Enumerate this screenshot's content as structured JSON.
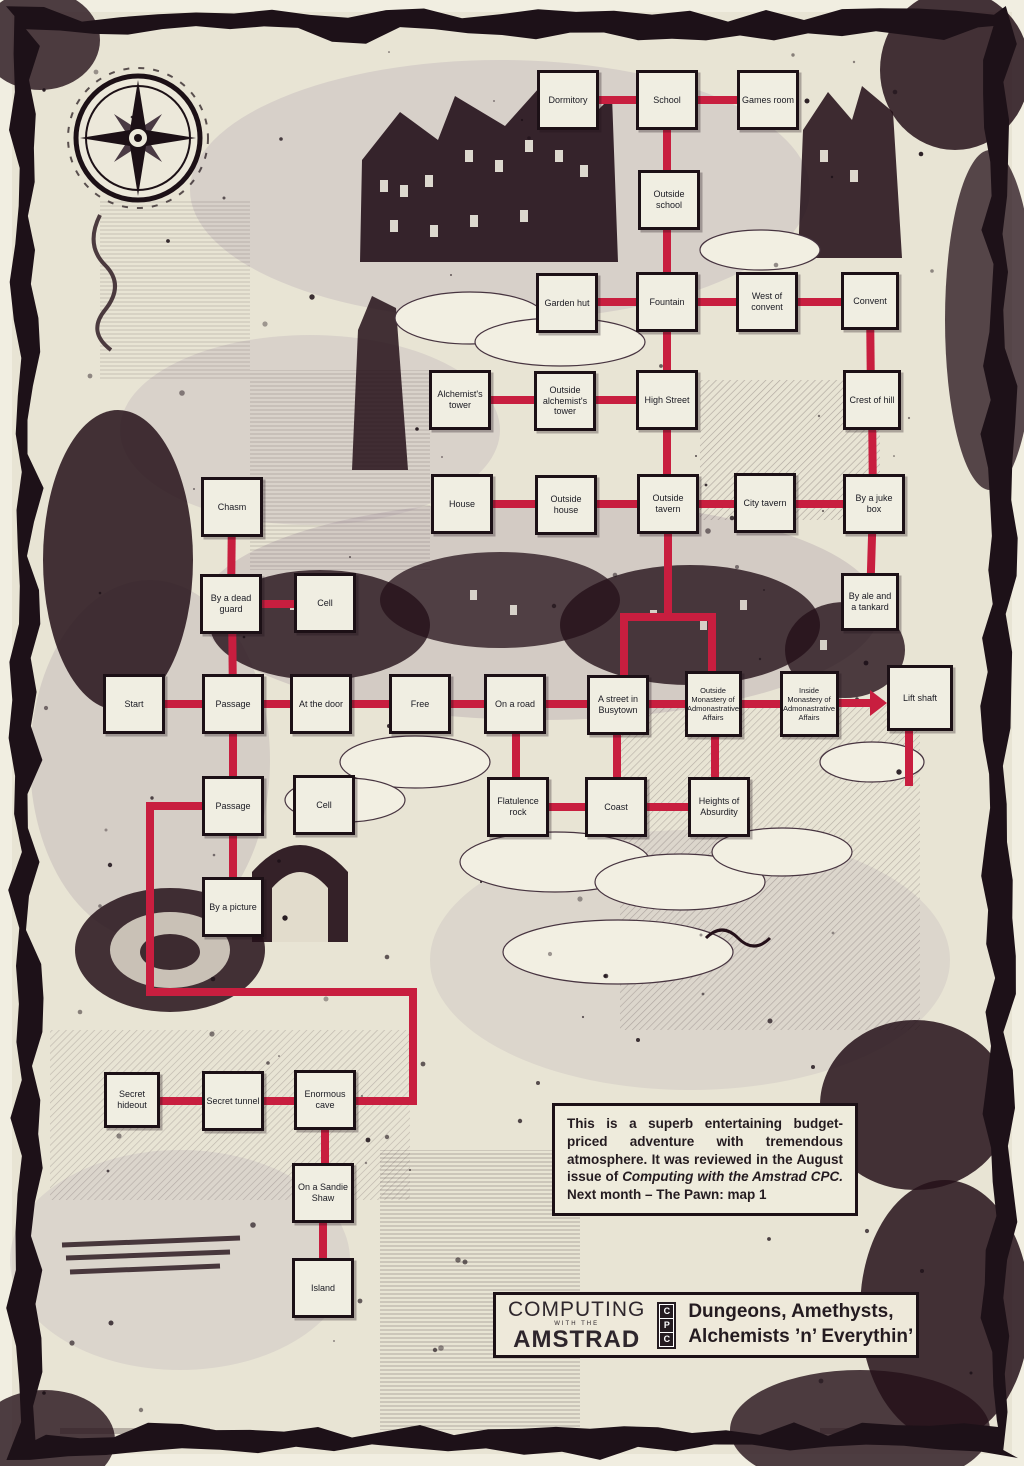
{
  "page_title": "Adventure game map — Dungeons, Amethysts, Alchemists ’n’ Everythin’",
  "colors": {
    "paper": "#e8e4d4",
    "ink": "#1d1118",
    "route_red": "#c81e3f",
    "box_fill": "#f0eee2"
  },
  "map_data": {
    "type": "diagram",
    "nodes": [
      {
        "id": "dormitory",
        "label": "Dormitory",
        "x": 568,
        "y": 100
      },
      {
        "id": "school",
        "label": "School",
        "x": 667,
        "y": 100
      },
      {
        "id": "games-room",
        "label": "Games room",
        "x": 768,
        "y": 100
      },
      {
        "id": "outside-school",
        "label": "Outside school",
        "x": 669,
        "y": 200
      },
      {
        "id": "garden-hut",
        "label": "Garden hut",
        "x": 567,
        "y": 303
      },
      {
        "id": "fountain",
        "label": "Fountain",
        "x": 667,
        "y": 302
      },
      {
        "id": "west-of-convent",
        "label": "West of convent",
        "x": 767,
        "y": 302
      },
      {
        "id": "convent",
        "label": "Convent",
        "x": 870,
        "y": 301,
        "w": 58,
        "h": 58
      },
      {
        "id": "alchemists-tower",
        "label": "Alchemist's tower",
        "x": 460,
        "y": 400
      },
      {
        "id": "outside-alchemists-tower",
        "label": "Outside alchemist's tower",
        "x": 565,
        "y": 401
      },
      {
        "id": "high-street",
        "label": "High Street",
        "x": 667,
        "y": 400
      },
      {
        "id": "crest-of-hill",
        "label": "Crest of hill",
        "x": 872,
        "y": 400,
        "w": 58
      },
      {
        "id": "chasm",
        "label": "Chasm",
        "x": 232,
        "y": 507
      },
      {
        "id": "house",
        "label": "House",
        "x": 462,
        "y": 504
      },
      {
        "id": "outside-house",
        "label": "Outside house",
        "x": 566,
        "y": 505
      },
      {
        "id": "outside-tavern",
        "label": "Outside tavern",
        "x": 668,
        "y": 504
      },
      {
        "id": "city-tavern",
        "label": "City tavern",
        "x": 765,
        "y": 503
      },
      {
        "id": "by-a-juke-box",
        "label": "By a juke box",
        "x": 874,
        "y": 504
      },
      {
        "id": "by-a-dead-guard",
        "label": "By a dead guard",
        "x": 231,
        "y": 604
      },
      {
        "id": "cell-upper",
        "label": "Cell",
        "x": 325,
        "y": 603
      },
      {
        "id": "by-ale-and-a-tankard",
        "label": "By ale and a tankard",
        "x": 870,
        "y": 602,
        "w": 58,
        "h": 58
      },
      {
        "id": "start",
        "label": "Start",
        "x": 134,
        "y": 704
      },
      {
        "id": "passage-upper",
        "label": "Passage",
        "x": 233,
        "y": 704
      },
      {
        "id": "at-the-door",
        "label": "At the door",
        "x": 321,
        "y": 704
      },
      {
        "id": "free",
        "label": "Free",
        "x": 420,
        "y": 704
      },
      {
        "id": "on-a-road",
        "label": "On a road",
        "x": 515,
        "y": 704
      },
      {
        "id": "a-street-in-busytown",
        "label": "A street in Busytown",
        "x": 618,
        "y": 705
      },
      {
        "id": "outside-monastery",
        "label": "Outside Monastery of Admonastrative Affairs",
        "x": 713,
        "y": 704,
        "w": 57,
        "h": 66,
        "fs": 7.5
      },
      {
        "id": "inside-monastery",
        "label": "Inside Monastery of Admonastrative Affairs",
        "x": 809,
        "y": 704,
        "w": 59,
        "h": 66,
        "fs": 7.5
      },
      {
        "id": "lift-shaft",
        "label": "Lift shaft",
        "x": 920,
        "y": 698,
        "w": 66,
        "h": 66
      },
      {
        "id": "passage-lower",
        "label": "Passage",
        "x": 233,
        "y": 806
      },
      {
        "id": "cell-lower",
        "label": "Cell",
        "x": 324,
        "y": 805
      },
      {
        "id": "flatulence-rock",
        "label": "Flatulence rock",
        "x": 518,
        "y": 807
      },
      {
        "id": "coast",
        "label": "Coast",
        "x": 616,
        "y": 807
      },
      {
        "id": "heights-of-absurdity",
        "label": "Heights of Absurdity",
        "x": 719,
        "y": 807
      },
      {
        "id": "by-a-picture",
        "label": "By a picture",
        "x": 233,
        "y": 907
      },
      {
        "id": "secret-hideout",
        "label": "Secret hideout",
        "x": 132,
        "y": 1100,
        "w": 56,
        "h": 56
      },
      {
        "id": "secret-tunnel",
        "label": "Secret tunnel",
        "x": 233,
        "y": 1101
      },
      {
        "id": "enormous-cave",
        "label": "Enormous cave",
        "x": 325,
        "y": 1100
      },
      {
        "id": "on-a-sandie-shaw",
        "label": "On a Sandie Shaw",
        "x": 323,
        "y": 1193
      },
      {
        "id": "island",
        "label": "Island",
        "x": 323,
        "y": 1288
      }
    ],
    "edges": [
      {
        "from": "dormitory",
        "to": "school",
        "points": [
          [
            568,
            100
          ],
          [
            667,
            100
          ]
        ]
      },
      {
        "from": "school",
        "to": "games-room",
        "points": [
          [
            667,
            100
          ],
          [
            768,
            100
          ]
        ]
      },
      {
        "from": "school",
        "to": "outside-school",
        "points": [
          [
            667,
            100
          ],
          [
            667,
            200
          ]
        ]
      },
      {
        "from": "outside-school",
        "to": "fountain",
        "points": [
          [
            667,
            200
          ],
          [
            667,
            302
          ]
        ]
      },
      {
        "from": "garden-hut",
        "to": "fountain",
        "points": [
          [
            567,
            302
          ],
          [
            667,
            302
          ]
        ]
      },
      {
        "from": "fountain",
        "to": "west-of-convent",
        "points": [
          [
            667,
            302
          ],
          [
            767,
            302
          ]
        ]
      },
      {
        "from": "west-of-convent",
        "to": "convent",
        "points": [
          [
            767,
            302
          ],
          [
            870,
            302
          ]
        ]
      },
      {
        "from": "fountain",
        "to": "high-street",
        "points": [
          [
            667,
            302
          ],
          [
            667,
            400
          ]
        ]
      },
      {
        "from": "convent",
        "to": "crest-of-hill",
        "points": [
          [
            870,
            301
          ],
          [
            871,
            400
          ]
        ]
      },
      {
        "from": "alchemists-tower",
        "to": "outside-alchemists-tower",
        "points": [
          [
            460,
            400
          ],
          [
            565,
            400
          ]
        ]
      },
      {
        "from": "outside-alchemists-tower",
        "to": "high-street",
        "points": [
          [
            565,
            400
          ],
          [
            667,
            400
          ]
        ]
      },
      {
        "from": "high-street",
        "to": "outside-tavern",
        "points": [
          [
            667,
            400
          ],
          [
            667,
            504
          ]
        ]
      },
      {
        "from": "crest-of-hill",
        "to": "by-a-juke-box",
        "points": [
          [
            872,
            400
          ],
          [
            873,
            504
          ]
        ]
      },
      {
        "from": "house",
        "to": "outside-house",
        "points": [
          [
            462,
            504
          ],
          [
            566,
            504
          ]
        ]
      },
      {
        "from": "outside-house",
        "to": "outside-tavern",
        "points": [
          [
            566,
            504
          ],
          [
            668,
            504
          ]
        ]
      },
      {
        "from": "outside-tavern",
        "to": "city-tavern",
        "points": [
          [
            668,
            504
          ],
          [
            765,
            504
          ]
        ]
      },
      {
        "from": "city-tavern",
        "to": "by-a-juke-box",
        "points": [
          [
            765,
            504
          ],
          [
            874,
            504
          ]
        ]
      },
      {
        "from": "by-a-juke-box",
        "to": "by-ale-and-a-tankard",
        "points": [
          [
            873,
            504
          ],
          [
            870,
            602
          ]
        ]
      },
      {
        "from": "chasm",
        "to": "by-a-dead-guard",
        "points": [
          [
            232,
            507
          ],
          [
            231,
            604
          ]
        ]
      },
      {
        "from": "by-a-dead-guard",
        "to": "cell-upper",
        "points": [
          [
            231,
            604
          ],
          [
            325,
            604
          ]
        ]
      },
      {
        "from": "by-a-dead-guard",
        "to": "passage-upper",
        "points": [
          [
            232,
            604
          ],
          [
            233,
            704
          ]
        ]
      },
      {
        "from": "outside-tavern",
        "to": "a-street-in-busytown",
        "points": [
          [
            668,
            504
          ],
          [
            668,
            617
          ],
          [
            624,
            617
          ],
          [
            624,
            705
          ]
        ]
      },
      {
        "from": "outside-tavern",
        "to": "outside-monastery",
        "points": [
          [
            668,
            617
          ],
          [
            712,
            617
          ],
          [
            712,
            704
          ]
        ]
      },
      {
        "from": "start",
        "to": "passage-upper",
        "points": [
          [
            134,
            704
          ],
          [
            233,
            704
          ]
        ]
      },
      {
        "from": "passage-upper",
        "to": "at-the-door",
        "points": [
          [
            233,
            704
          ],
          [
            321,
            704
          ]
        ]
      },
      {
        "from": "at-the-door",
        "to": "free",
        "points": [
          [
            321,
            704
          ],
          [
            420,
            704
          ]
        ]
      },
      {
        "from": "free",
        "to": "on-a-road",
        "points": [
          [
            420,
            704
          ],
          [
            515,
            704
          ]
        ]
      },
      {
        "from": "on-a-road",
        "to": "a-street-in-busytown",
        "points": [
          [
            515,
            704
          ],
          [
            618,
            704
          ]
        ]
      },
      {
        "from": "a-street-in-busytown",
        "to": "outside-monastery",
        "points": [
          [
            618,
            704
          ],
          [
            713,
            704
          ]
        ]
      },
      {
        "from": "outside-monastery",
        "to": "inside-monastery",
        "points": [
          [
            713,
            704
          ],
          [
            809,
            704
          ]
        ]
      },
      {
        "from": "inside-monastery",
        "to": "lift-shaft",
        "points": [
          [
            809,
            703
          ],
          [
            870,
            703
          ]
        ],
        "arrow": true
      },
      {
        "from": "passage-upper",
        "to": "passage-lower",
        "points": [
          [
            233,
            704
          ],
          [
            233,
            806
          ]
        ]
      },
      {
        "from": "on-a-road",
        "to": "flatulence-rock",
        "points": [
          [
            516,
            704
          ],
          [
            516,
            807
          ]
        ]
      },
      {
        "from": "a-street-in-busytown",
        "to": "coast",
        "points": [
          [
            617,
            705
          ],
          [
            617,
            807
          ]
        ]
      },
      {
        "from": "outside-monastery",
        "to": "heights-of-absurdity",
        "points": [
          [
            715,
            704
          ],
          [
            715,
            807
          ]
        ]
      },
      {
        "from": "flatulence-rock",
        "to": "coast",
        "points": [
          [
            518,
            807
          ],
          [
            616,
            807
          ]
        ]
      },
      {
        "from": "coast",
        "to": "heights-of-absurdity",
        "points": [
          [
            616,
            807
          ],
          [
            719,
            807
          ]
        ]
      },
      {
        "from": "passage-lower",
        "to": "by-a-picture",
        "points": [
          [
            233,
            806
          ],
          [
            233,
            907
          ]
        ]
      },
      {
        "from": "passage-lower",
        "to": "enormous-cave",
        "points": [
          [
            233,
            806
          ],
          [
            150,
            806
          ],
          [
            150,
            992
          ],
          [
            413,
            992
          ],
          [
            413,
            1101
          ],
          [
            325,
            1101
          ]
        ]
      },
      {
        "from": "secret-hideout",
        "to": "secret-tunnel",
        "points": [
          [
            132,
            1101
          ],
          [
            233,
            1101
          ]
        ]
      },
      {
        "from": "secret-tunnel",
        "to": "enormous-cave",
        "points": [
          [
            233,
            1101
          ],
          [
            325,
            1101
          ]
        ]
      },
      {
        "from": "enormous-cave",
        "to": "on-a-sandie-shaw",
        "points": [
          [
            325,
            1100
          ],
          [
            325,
            1193
          ]
        ]
      },
      {
        "from": "on-a-sandie-shaw",
        "to": "island",
        "points": [
          [
            323,
            1193
          ],
          [
            323,
            1288
          ]
        ]
      },
      {
        "from": "lift-shaft",
        "to": null,
        "points": [
          [
            909,
            698
          ],
          [
            909,
            786
          ]
        ]
      }
    ]
  },
  "review_note": {
    "text_before_italic": "This is a superb entertaining budget-priced adventure with tremendous atmosphere. It was reviewed in the August issue of ",
    "italic_text": "Computing with the Amstrad CPC.",
    "text_after_italic": " Next month – The Pawn: map 1"
  },
  "logo_box": {
    "computing": "COMPUTING",
    "with_the": "WITH THE",
    "amstrad": "AMSTRAD",
    "cpc": [
      "C",
      "P",
      "C"
    ],
    "game_title_line1": "Dungeons, Amethysts,",
    "game_title_line2": "Alchemists ’n’ Everythin’"
  }
}
